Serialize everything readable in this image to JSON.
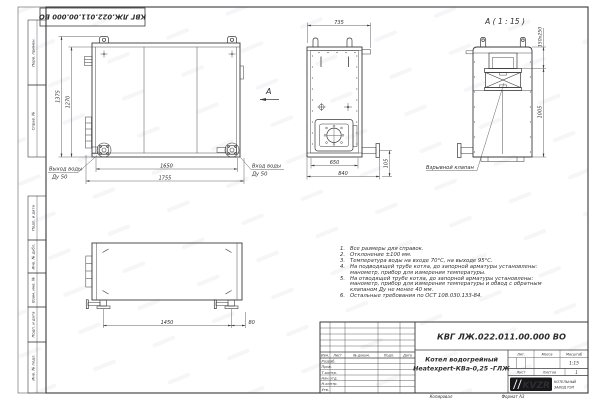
{
  "sheet": {
    "stamp_top": "КВГ ЛЖ.022.011.00.000 ВО",
    "margin_labels": {
      "perv_primen": "Перв. примен.",
      "sprav_no": "Справ. №",
      "podp_data_1": "Подп. и дата",
      "inv_dubl": "Инв. № дубл.",
      "vzam_inv": "Взам. инв. №",
      "podp_data_2": "Подп. и дата",
      "inv_podl": "Инв. № подл."
    },
    "footer": {
      "kopiroval": "Копировал",
      "format": "Формат А3"
    }
  },
  "views": {
    "front": {
      "dims": {
        "h1": "1375",
        "h2": "1270",
        "w1": "1650",
        "w2": "1755"
      },
      "outlet_label_1": "Выход воды",
      "outlet_label_2": "Ду 50",
      "inlet_label_1": "Вход воды",
      "inlet_label_2": "Ду 50",
      "view_arrow": "А"
    },
    "side": {
      "dims": {
        "top": "735",
        "w1": "650",
        "w2": "840",
        "pipe": "105"
      }
    },
    "detail": {
      "title": "А ( 1 : 15 )",
      "dims": {
        "opening": "150x250",
        "height": "1005"
      },
      "valve_label": "Взрывной клапан"
    },
    "bottom_view": {
      "dims": {
        "span": "1450",
        "offset": "80"
      }
    }
  },
  "notes": [
    {
      "n": "1.",
      "text": "Все размеры для справок."
    },
    {
      "n": "2.",
      "text": "Отклонение ±100 мм."
    },
    {
      "n": "3.",
      "text": "Температура воды на входе 70°С, на выходе 95°С."
    },
    {
      "n": "4.",
      "text": "На подводящей трубе котла, до запорной арматуры установлены: манометр, прибор для измерения температуры."
    },
    {
      "n": "5.",
      "text": "На отводящей трубе котла, до запорной арматуры установлены: манометр, прибор для измерения температуры и обвод с обратным клапаном Ду не менее 40 мм."
    },
    {
      "n": "6.",
      "text": "Остальные требования по ОСТ 108.030.133-84."
    }
  ],
  "title_block": {
    "doc_number": "КВГ ЛЖ.022.011.00.000 ВО",
    "name_line1": "Котел водогрейный",
    "name_line2": "Heatexpert-КВа-0,25 -ГЛЖ",
    "col_headers": [
      "Изм.",
      "Лист",
      "№ докум.",
      "Подп.",
      "Дата"
    ],
    "row_labels": [
      "Разраб.",
      "Пров.",
      "Т.контр.",
      "Нач.отд.",
      "Н.контр.",
      "Утв."
    ],
    "lit_label": "Лит.",
    "mass_label": "Масса",
    "scale_label": "Масштаб",
    "scale_value": "1:15",
    "sheet_label": "Лист",
    "sheets_label": "Листов",
    "sheets_value": "1",
    "logo_text": "KVZR",
    "logo_caption_1": "КОТЕЛЬНЫЙ",
    "logo_caption_2": "ЗАВОД РЭП"
  },
  "colors": {
    "line": "#3a3a3c",
    "text": "#2e2e30",
    "sheet": "#ffffff",
    "logo_bg": "#17171a"
  }
}
